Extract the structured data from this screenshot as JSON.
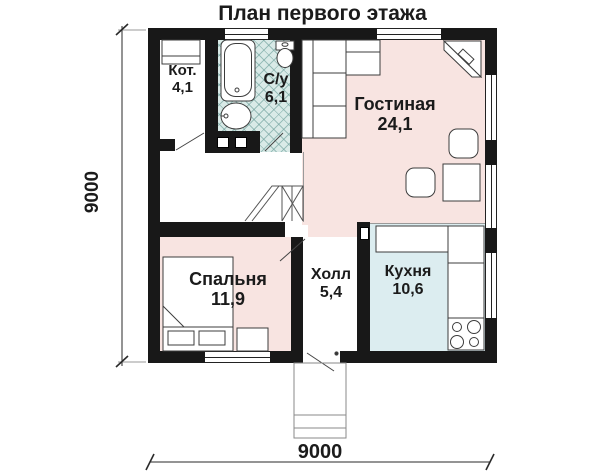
{
  "title": "План первого этажа",
  "dimensions": {
    "vertical": "9000",
    "horizontal": "9000"
  },
  "rooms": {
    "boiler": {
      "name": "Кот.",
      "area": "4,1"
    },
    "bathroom": {
      "name": "С/у",
      "area": "6,1"
    },
    "living": {
      "name": "Гостиная",
      "area": "24,1"
    },
    "bedroom": {
      "name": "Спальня",
      "area": "11,9"
    },
    "hall": {
      "name": "Холл",
      "area": "5,4"
    },
    "kitchen": {
      "name": "Кухня",
      "area": "10,6"
    }
  },
  "colors": {
    "wall": "#181818",
    "room_pink": "#f8e4e1",
    "kitchen_blue": "#dcedf0",
    "bath_tile": "#d9eae7",
    "text": "#1b1b1b"
  },
  "fixtures": [
    "bathtub",
    "sink",
    "toilet",
    "boiler-unit",
    "corner-sofa",
    "corner-desk",
    "dining-table",
    "chairs",
    "bed",
    "pillows",
    "nightstand",
    "stairs",
    "kitchen-counter",
    "stove",
    "porch-steps",
    "door-swings",
    "windows"
  ]
}
